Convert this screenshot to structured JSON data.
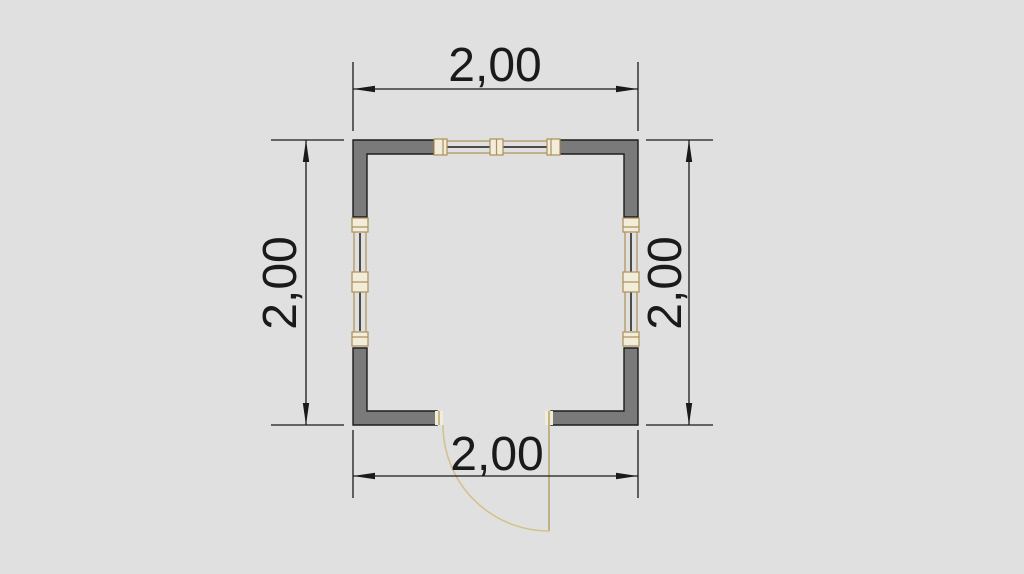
{
  "drawing": {
    "type": "architectural-floor-plan",
    "room": {
      "width_label": "2,00",
      "height_label": "2,00"
    },
    "dimensions": {
      "top": "2,00",
      "bottom": "2,00",
      "left": "2,00",
      "right": "2,00"
    },
    "features": {
      "window_top": "window",
      "window_left": "window",
      "window_right": "window",
      "door_bottom": "door-with-swing-arc"
    }
  },
  "colors": {
    "background": "#e0e0e0",
    "wall_fill": "#7a7a7a",
    "wall_stroke": "#1c1c1c",
    "dimension": "#1a1a1a",
    "frame_stroke": "#ab9058",
    "frame_fill": "#f2ecda",
    "glass": "#1a1a1a",
    "door_arc": "#d2c28d",
    "door_leaf": "#b2a268"
  }
}
